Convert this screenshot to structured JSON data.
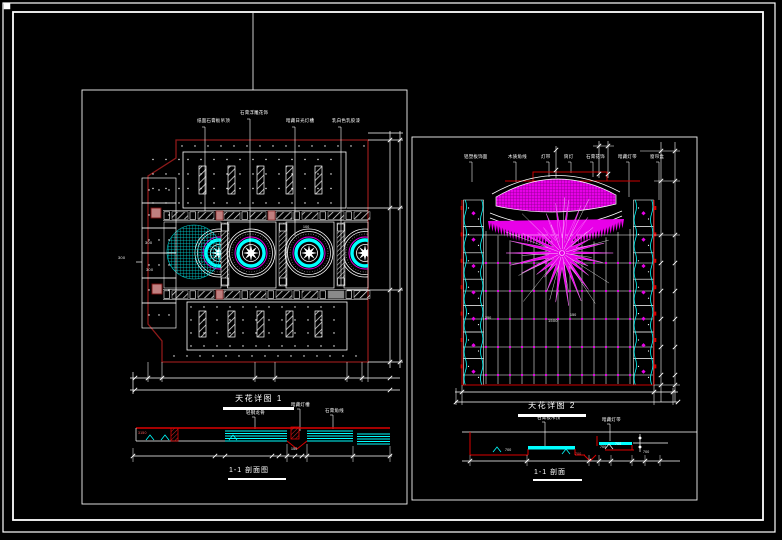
{
  "colors": {
    "background": "#000000",
    "frame_white": "#ffffff",
    "outline_dark_red": "#8e1a1a",
    "bright_red": "#dd0000",
    "cyan": "#00ffff",
    "magenta": "#e800e8",
    "pink_fill": "#c08080",
    "gray_fill": "#8a8a8a"
  },
  "drawing1": {
    "title": "天花详图 1",
    "section_title": "1-1 剖面图",
    "leader_labels": [
      "纸面石膏板吊顶",
      "石膏浮雕花饰",
      "暗藏日光灯槽",
      "乳白色乳胶漆"
    ],
    "section_labels": [
      "轻钢龙骨",
      "暗藏灯槽",
      "石膏角线"
    ],
    "dim_texts": [
      "300",
      "300",
      "300",
      "100",
      "3150",
      "150"
    ]
  },
  "drawing2": {
    "title": "天花详图 2",
    "section_title": "1-1 剖面",
    "leader_labels": [
      "铝塑板饰面",
      "木质角线",
      "灯带",
      "筒灯",
      "石膏花饰",
      "暗藏灯带",
      "窗帘盒"
    ],
    "section_labels": [
      "石膏板吊顶",
      "暗藏灯带"
    ],
    "dim_texts": [
      "1500",
      "150",
      "250",
      "700",
      "700",
      "700",
      "700",
      "700"
    ]
  }
}
